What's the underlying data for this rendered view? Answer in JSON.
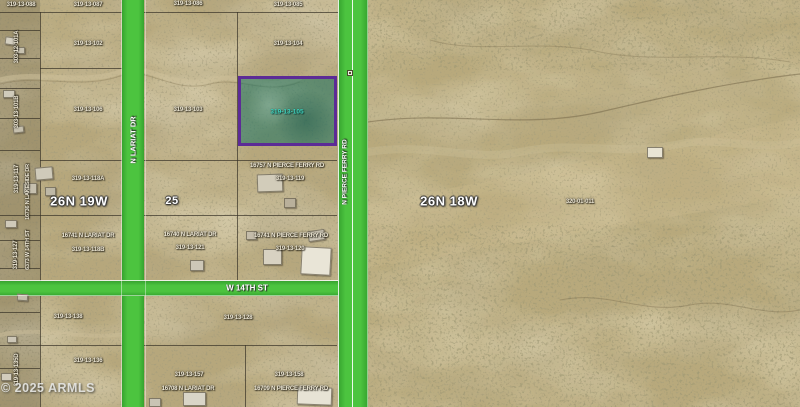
{
  "map": {
    "attribution": "© 2025 ARMLS",
    "township_left": "26N 19W",
    "township_right": "26N 18W",
    "section_number": "25",
    "roads": {
      "lariat": "N LARIAT DR",
      "pierce_ferry": "N PIERCE FERRY RD",
      "w_14th": "W 14TH ST"
    },
    "highlight": {
      "apn": "319-13-105",
      "outline_color": "#5C2B96",
      "fill_color": "rgba(17,112,95,0.52)",
      "label_color": "#41D6C0"
    },
    "colors": {
      "road_green": "#44BD3A",
      "desert_base": "#B6A77C",
      "parcel_line": "#383226"
    },
    "labels": [
      {
        "text": "319-13-088",
        "x": 21,
        "y": 5,
        "kind": "parcel-label"
      },
      {
        "text": "319-13-087",
        "x": 88,
        "y": 5,
        "kind": "parcel-label"
      },
      {
        "text": "319-13-086",
        "x": 188,
        "y": 4,
        "kind": "parcel-label"
      },
      {
        "text": "319-13-085",
        "x": 288,
        "y": 5,
        "kind": "parcel-label"
      },
      {
        "text": "319-13-102",
        "x": 88,
        "y": 44,
        "kind": "parcel-label"
      },
      {
        "text": "319-13-104",
        "x": 288,
        "y": 44,
        "kind": "parcel-label"
      },
      {
        "text": "319-13-106",
        "x": 88,
        "y": 110,
        "kind": "parcel-label"
      },
      {
        "text": "319-13-103",
        "x": 188,
        "y": 110,
        "kind": "parcel-label"
      },
      {
        "text": "319-13-118A",
        "x": 88,
        "y": 179,
        "kind": "parcel-label"
      },
      {
        "text": "16757 N PIERCE FERRY RD",
        "x": 287,
        "y": 166,
        "kind": "address-label",
        "cls": "addr"
      },
      {
        "text": "319-13-119",
        "x": 290,
        "y": 179,
        "kind": "parcel-label"
      },
      {
        "text": "16741 N LARIAT DR",
        "x": 88,
        "y": 236,
        "kind": "address-label",
        "cls": "addr"
      },
      {
        "text": "319-13-118B",
        "x": 88,
        "y": 250,
        "kind": "parcel-label"
      },
      {
        "text": "16740 N LARIAT DR",
        "x": 190,
        "y": 235,
        "kind": "address-label",
        "cls": "addr"
      },
      {
        "text": "319-13-121",
        "x": 190,
        "y": 248,
        "kind": "parcel-label"
      },
      {
        "text": "16741 N PIERCE FERRY RD",
        "x": 291,
        "y": 236,
        "kind": "address-label",
        "cls": "addr"
      },
      {
        "text": "319-13-120",
        "x": 290,
        "y": 249,
        "kind": "parcel-label"
      },
      {
        "text": "319-13-138",
        "x": 68,
        "y": 317,
        "kind": "parcel-label"
      },
      {
        "text": "319-13-128",
        "x": 238,
        "y": 318,
        "kind": "parcel-label"
      },
      {
        "text": "319-13-136",
        "x": 88,
        "y": 361,
        "kind": "parcel-label"
      },
      {
        "text": "319-13-157",
        "x": 189,
        "y": 375,
        "kind": "parcel-label"
      },
      {
        "text": "16708 N LARIAT DR",
        "x": 188,
        "y": 389,
        "kind": "address-label",
        "cls": "addr"
      },
      {
        "text": "319-13-158",
        "x": 289,
        "y": 375,
        "kind": "parcel-label"
      },
      {
        "text": "16709 N PIERCE FERRY RD",
        "x": 291,
        "y": 389,
        "kind": "address-label",
        "cls": "addr"
      },
      {
        "text": "320-01-011",
        "x": 580,
        "y": 202,
        "kind": "parcel-label"
      },
      {
        "text": "303-12-101A",
        "x": 17,
        "y": 47,
        "o": "v",
        "kind": "parcel-label"
      },
      {
        "text": "303-13-101B",
        "x": 17,
        "y": 112,
        "o": "v",
        "kind": "parcel-label"
      },
      {
        "text": "319-13-117",
        "x": 17,
        "y": 179,
        "o": "v",
        "kind": "parcel-label"
      },
      {
        "text": "16736 N LAKESIDE DR",
        "x": 28,
        "y": 192,
        "o": "v",
        "kind": "address-label",
        "cls": "small"
      },
      {
        "text": "319-13-127",
        "x": 16,
        "y": 255,
        "o": "v",
        "kind": "parcel-label"
      },
      {
        "text": "6373 W 14TH ST",
        "x": 28,
        "y": 250,
        "o": "v",
        "kind": "address-label",
        "cls": "small"
      },
      {
        "text": "319-13-135D",
        "x": 17,
        "y": 370,
        "o": "v",
        "kind": "parcel-label"
      }
    ]
  }
}
